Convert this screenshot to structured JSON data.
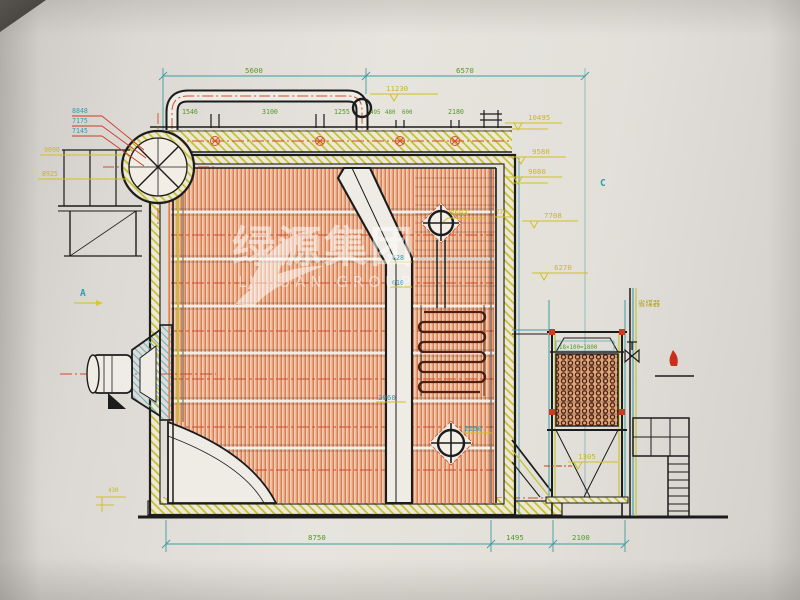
{
  "document": {
    "kind": "boiler side-section engineering drawing (photographed CAD print)",
    "colors": {
      "paper": "#e3e0da",
      "line": "#1c1c1c",
      "tube_orange": "#dd7c4e",
      "centerline_red": "#cf4b28",
      "insulation_yellow": "#c3c02c",
      "dim_teal": "#3e9ba0",
      "label_yellow": "#c9b81d",
      "label_cyan": "#2d9fae",
      "label_green": "#55982a",
      "coil_brown": "#571f10"
    }
  },
  "watermark": {
    "cn": "绿源集团",
    "en": "LVYUAN GROUP"
  },
  "labels": {
    "dim_top_left": "5600",
    "dim_top_right": "6570",
    "elev_top": "11230",
    "hdr_1": "1546",
    "hdr_2": "3100",
    "hdr_3": "1255",
    "hdr_4": "495",
    "hdr_5": "480",
    "hdr_6": "600",
    "hdr_7": "2180",
    "elev_r1": "10495",
    "elev_r2": "9580",
    "elev_r3": "9080",
    "elev_r4": "7708",
    "elev_r5": "6270",
    "elev_r6": "1305",
    "elev_l1": "9090",
    "elev_l2": "8925",
    "pipe_l1": "8848",
    "pipe_l2": "7175",
    "pipe_l3": "7145",
    "ann_8603": "8603",
    "ann_770": "770",
    "ann_628": "628",
    "ann_610": "610",
    "ann_2960": "2960",
    "ann_2100": "2100",
    "econ_pitch": "18×100=1800",
    "econ_name": "省煤器",
    "base_430": "430",
    "sec_a": "A",
    "sec_c": "C",
    "dim_b1": "8750",
    "dim_b2": "1495",
    "dim_b3": "2100"
  }
}
